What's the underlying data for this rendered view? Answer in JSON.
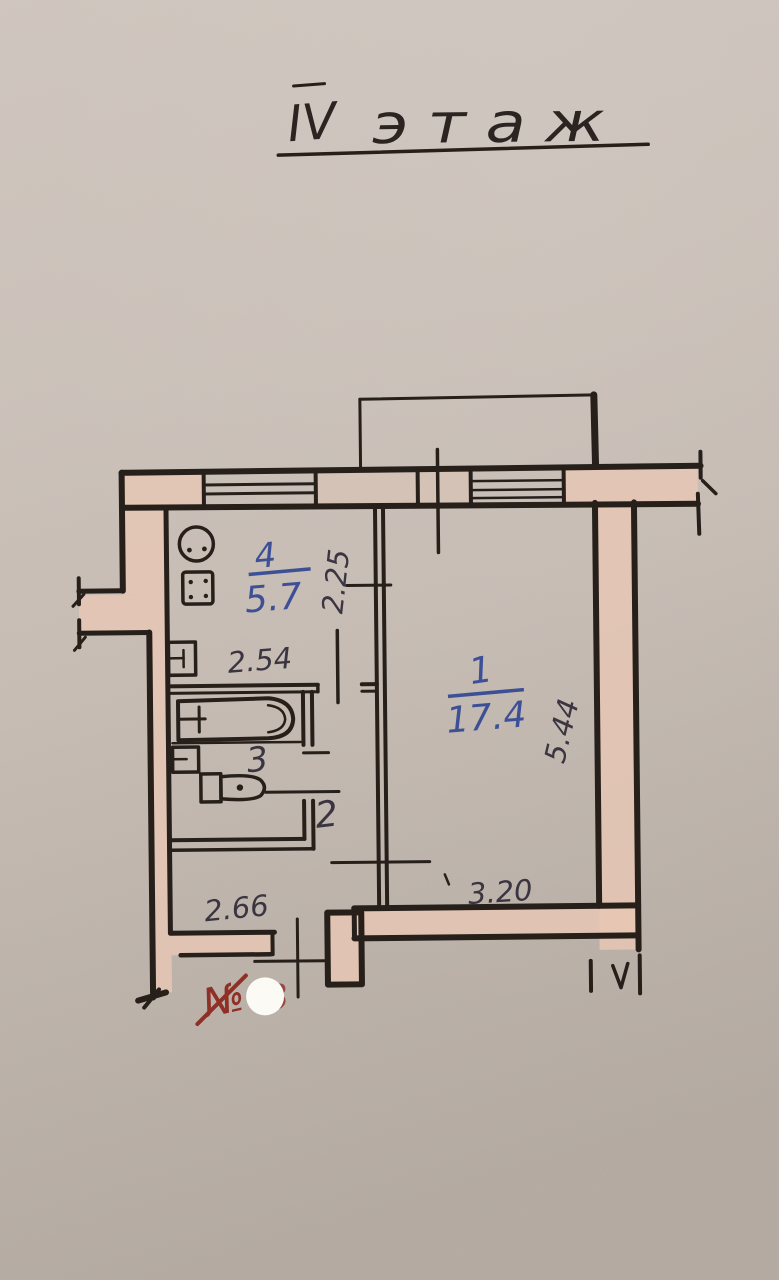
{
  "title": {
    "roman": "IV",
    "word": "этаж"
  },
  "rooms": [
    {
      "number": "1",
      "area": "17.4"
    },
    {
      "number": "2"
    },
    {
      "number": "3"
    },
    {
      "number": "4",
      "area": "5.7"
    }
  ],
  "dimensions": {
    "kitchen_height": "2.25",
    "kitchen_width": "2.54",
    "hall_width": "2.66",
    "room1_width": "3.20",
    "room1_height": "5.44"
  },
  "stamp": {
    "numero_sign": "№",
    "covered_digit": "3"
  },
  "colors": {
    "paper_top": "#d7cec8",
    "paper_mid": "#c7bdb5",
    "paper_bottom": "#a29a93",
    "wall_fill": "#e8c7b4",
    "ink": "#261f1a",
    "ink_text": "#3a3540",
    "blue_ink": "#3d5096",
    "red_ink": "#8e3026",
    "whiteout": "#fbfaf5"
  }
}
